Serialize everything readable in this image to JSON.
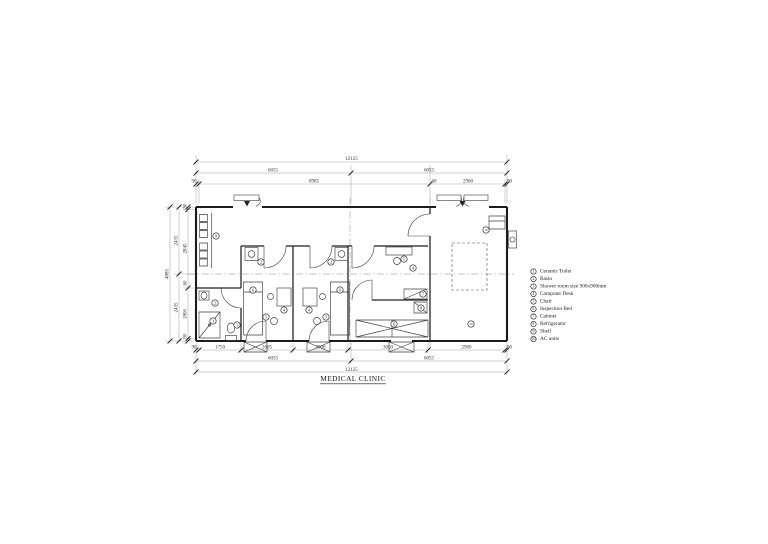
{
  "title": "MEDICAL CLINIC",
  "legend": {
    "items": [
      {
        "num": "1",
        "label": "Ceramic Toilet"
      },
      {
        "num": "2",
        "label": "Basin"
      },
      {
        "num": "3",
        "label": "Shower room size 900x900mm"
      },
      {
        "num": "4",
        "label": "Computer Desk"
      },
      {
        "num": "5",
        "label": "Chair"
      },
      {
        "num": "6",
        "label": "Inspection Bed"
      },
      {
        "num": "7",
        "label": "Cabinet"
      },
      {
        "num": "8",
        "label": "Refrigerator"
      },
      {
        "num": "9",
        "label": "Shelf"
      },
      {
        "num": "10",
        "label": "AC units"
      }
    ]
  },
  "dimensions": {
    "top": {
      "total": "12125",
      "halves": [
        "6055",
        "6055"
      ],
      "detail": [
        "90",
        "8985",
        "60",
        "2900",
        "90"
      ]
    },
    "bottom": {
      "rooms": [
        "90",
        "1750",
        "2605",
        "2000",
        "3050",
        "2900",
        "90"
      ],
      "halves": [
        "6055",
        "6055"
      ],
      "total": "12125"
    },
    "left": {
      "total": "4885",
      "halves": [
        "2435",
        "2435"
      ],
      "detail": [
        "90",
        "2845",
        "60",
        "1800",
        "90"
      ]
    }
  },
  "plan_labels": {
    "waiting_shelf": "9",
    "wc_basin": "2",
    "wc_toilet": "1",
    "wc_shower": "3",
    "room_a_basin": "2",
    "room_a_bed": "6",
    "room_a_desk": "4",
    "room_a_chair": "5",
    "room_b_basin": "2",
    "room_b_bed": "6",
    "room_b_desk": "4",
    "room_b_chair": "5",
    "room_c_chair": "5",
    "room_c_desk": "4",
    "room_c_cabinet": "7",
    "room_c_fridge": "8",
    "ward_bed": "6",
    "ac_unit_top": "10",
    "ac_unit_bottom": "10"
  }
}
